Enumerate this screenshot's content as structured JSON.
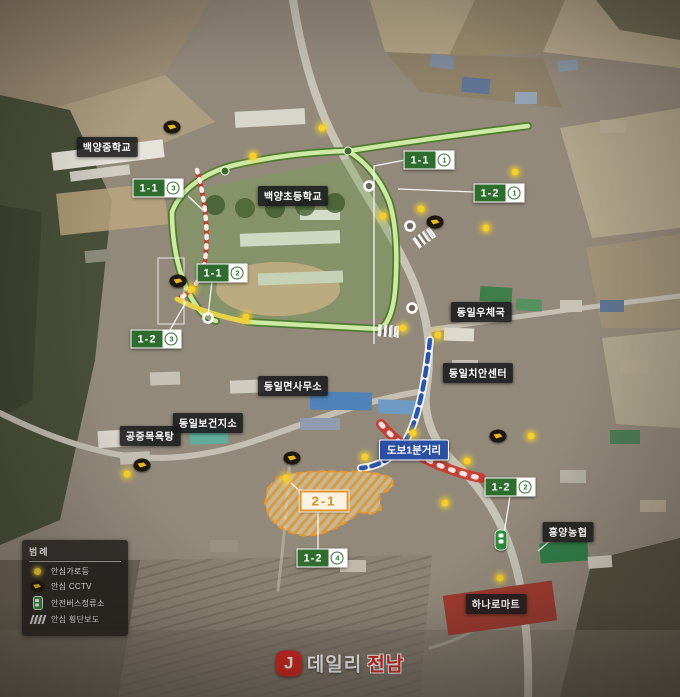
{
  "map": {
    "place_labels": [
      {
        "id": "baekyang-middle-school",
        "text": "백양중학교",
        "x": 107,
        "y": 147
      },
      {
        "id": "baekyang-elementary-school",
        "text": "백양초등학교",
        "x": 293,
        "y": 196
      },
      {
        "id": "dongil-post-office",
        "text": "동일우체국",
        "x": 481,
        "y": 312
      },
      {
        "id": "dongil-police-center",
        "text": "동일치안센터",
        "x": 478,
        "y": 373
      },
      {
        "id": "dongil-myeon-office",
        "text": "동일면사무소",
        "x": 293,
        "y": 386
      },
      {
        "id": "dongil-health-branch",
        "text": "동일보건지소",
        "x": 208,
        "y": 423
      },
      {
        "id": "public-bathhouse",
        "text": "공중목욕탕",
        "x": 150,
        "y": 436
      },
      {
        "id": "heungyang-nonghyup",
        "text": "흥양농협",
        "x": 568,
        "y": 532
      },
      {
        "id": "hanaro-mart",
        "text": "하나로마트",
        "x": 496,
        "y": 604
      }
    ],
    "route_badges": [
      {
        "id": "1-1-1",
        "code": "1-1",
        "circled": "1",
        "x": 429,
        "y": 160
      },
      {
        "id": "1-1-2",
        "code": "1-1",
        "circled": "2",
        "x": 222,
        "y": 273
      },
      {
        "id": "1-1-3",
        "code": "1-1",
        "circled": "3",
        "x": 158,
        "y": 188
      },
      {
        "id": "1-2-1",
        "code": "1-2",
        "circled": "1",
        "x": 499,
        "y": 193
      },
      {
        "id": "1-2-2",
        "code": "1-2",
        "circled": "2",
        "x": 510,
        "y": 487
      },
      {
        "id": "1-2-3",
        "code": "1-2",
        "circled": "3",
        "x": 156,
        "y": 339
      },
      {
        "id": "1-2-4",
        "code": "1-2",
        "circled": "4",
        "x": 322,
        "y": 558
      }
    ],
    "zone_badge": {
      "code": "2-1"
    },
    "distance_badge": {
      "text": "도보1분거리"
    },
    "legend": {
      "title": "범례",
      "items": [
        {
          "icon": "streetlight",
          "label": "안심가로등"
        },
        {
          "icon": "cctv",
          "label": "안심 CCTV"
        },
        {
          "icon": "bus-stop",
          "label": "안전버스정류소"
        },
        {
          "icon": "crosswalk",
          "label": "안심 횡단보도"
        }
      ]
    },
    "logo": {
      "mark": "J",
      "prefix": "데일리",
      "suffix": "전남"
    },
    "colors": {
      "route_green": "#4c7b2b",
      "badge_green": "#2f6d2f",
      "zone_orange": "#e8952e",
      "walk_blue": "#2a55ad",
      "distance_badge_blue": "#2b4fa3",
      "streetlight_yellow": "#f7ce2a",
      "logo_red": "#d6261f"
    }
  },
  "markers": {
    "streetlights": [
      [
        253,
        156
      ],
      [
        322,
        128
      ],
      [
        515,
        172
      ],
      [
        421,
        209
      ],
      [
        383,
        216
      ],
      [
        486,
        228
      ],
      [
        192,
        289
      ],
      [
        246,
        317
      ],
      [
        403,
        328
      ],
      [
        438,
        335
      ],
      [
        531,
        436
      ],
      [
        467,
        461
      ],
      [
        127,
        474
      ],
      [
        286,
        478
      ],
      [
        365,
        457
      ],
      [
        413,
        433
      ],
      [
        445,
        503
      ],
      [
        500,
        578
      ]
    ],
    "cctv": [
      [
        172,
        127
      ],
      [
        435,
        222
      ],
      [
        178,
        281
      ],
      [
        292,
        458
      ],
      [
        142,
        465
      ],
      [
        498,
        436
      ]
    ],
    "bus_stops": [
      [
        501,
        540
      ]
    ],
    "crosswalks": [
      {
        "x": 424,
        "y": 238,
        "rot": -35
      },
      {
        "x": 388,
        "y": 331,
        "rot": 4
      }
    ]
  }
}
